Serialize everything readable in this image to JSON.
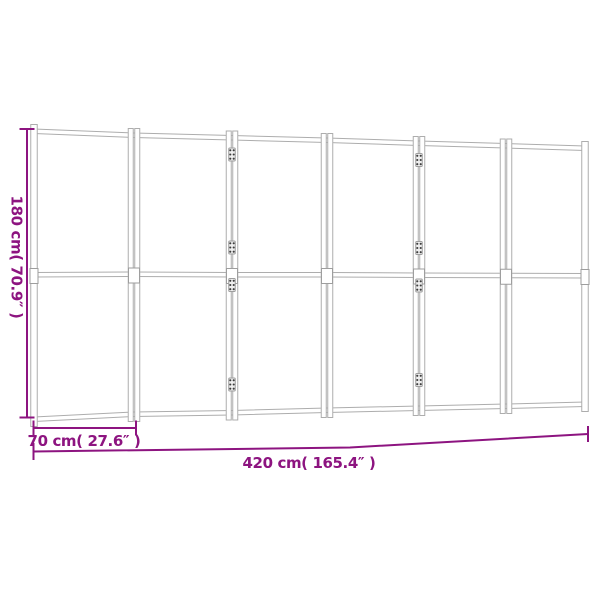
{
  "image": {
    "subject": "folding room divider screen shown with measurement lines",
    "panel_count": 6,
    "hinged_joints_shown": 2
  },
  "dimensions": {
    "height_label": "180 cm( 70.9″ )",
    "panel_width_label": "70 cm( 27.6″ )",
    "total_width_label": "420 cm( 165.4″ )"
  },
  "colors": {
    "dimension_line": "#8D1480",
    "frame_line": "#ADADAD",
    "bracket_line": "#9E9E9E",
    "hinge_fill": "#EFEFEF",
    "hinge_dot": "#3C3C3C",
    "background": "#FFFFFF"
  }
}
